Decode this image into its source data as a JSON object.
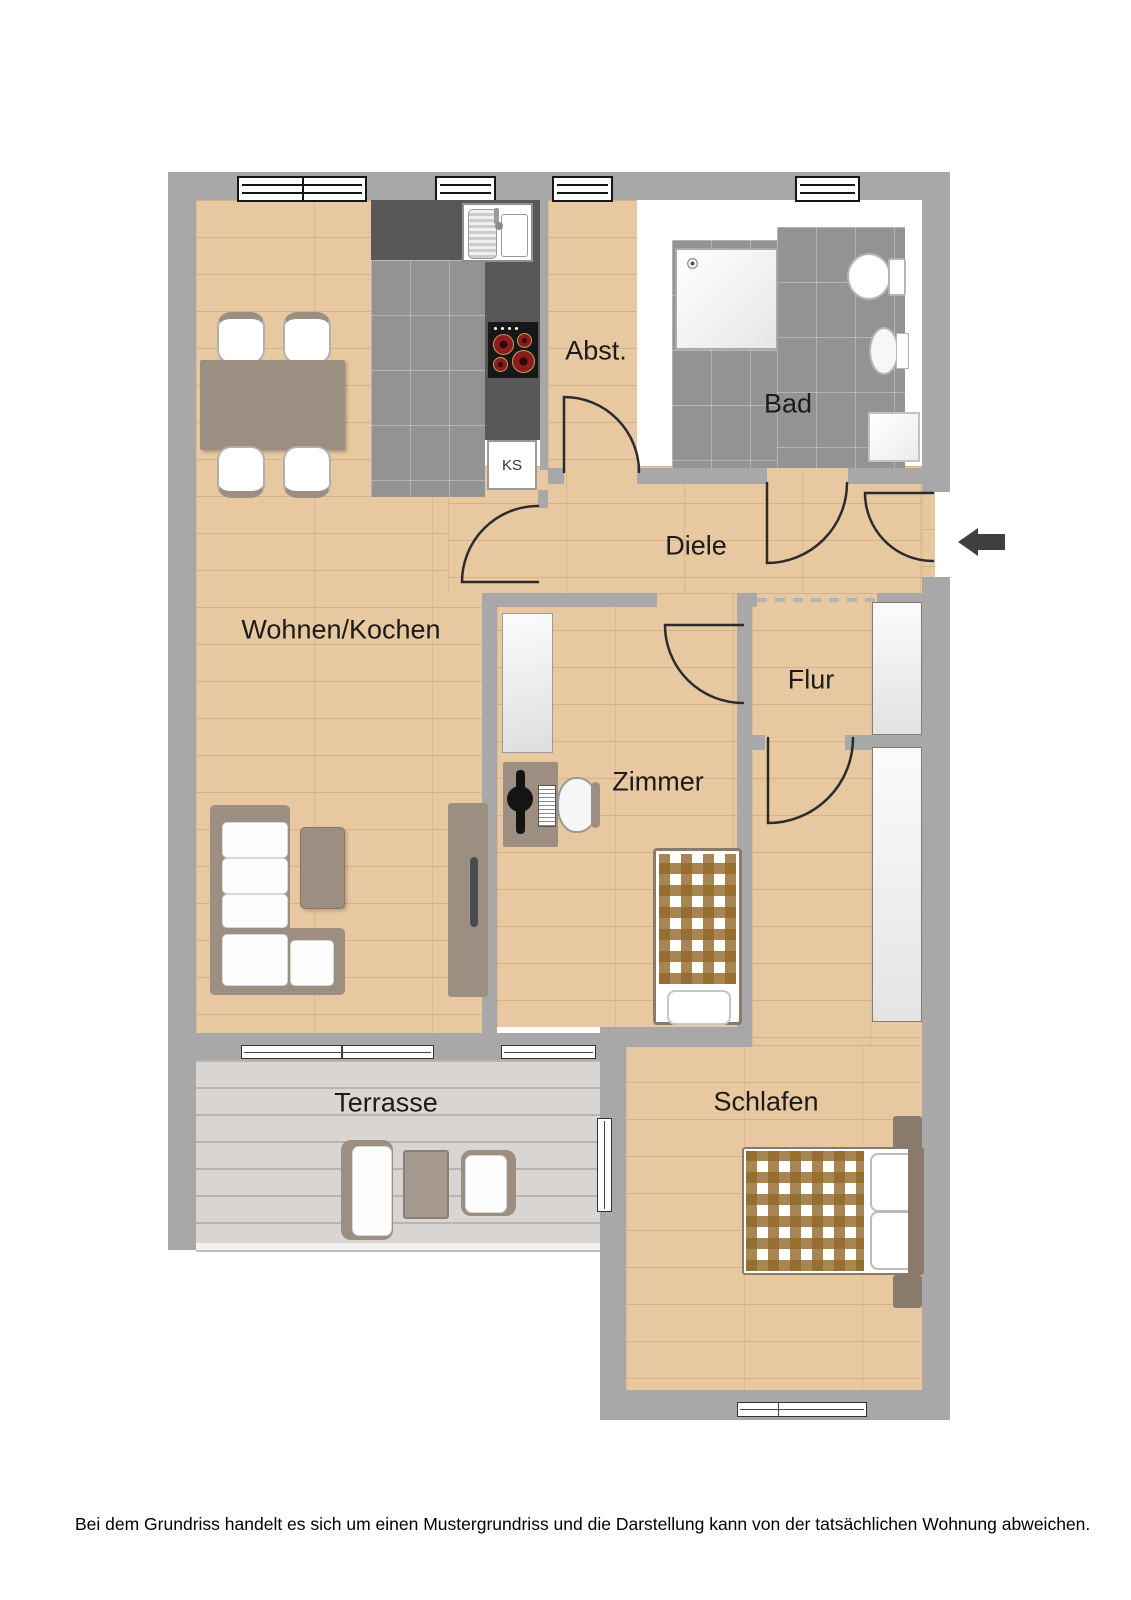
{
  "rooms": [
    {
      "label": "Abst."
    },
    {
      "label": "Bad"
    },
    {
      "label": "Diele"
    },
    {
      "label": "Wohnen/Kochen"
    },
    {
      "label": "Flur"
    },
    {
      "label": "Zimmer"
    },
    {
      "label": "Terrasse"
    },
    {
      "label": "Schlafen"
    }
  ],
  "kitchen": {
    "fridge_label": "KS"
  },
  "entrance": {
    "arrow_direction": "left"
  },
  "disclaimer": "Bei dem Grundriss handelt es sich um einen Mustergrundriss und die Darstellung kann von der tatsächlichen Wohnung abweichen.",
  "colors": {
    "wall": "#a8a8a8",
    "wood_floor": "#e8c8a0",
    "tile_floor": "#939393",
    "deck_floor": "#d9d5d2",
    "kitchen_counter": "#585858",
    "furniture_brown": "#9c8e80",
    "bed_frame_brown": "#8a7a6c",
    "burner_red": "#8c1d1d",
    "entrance_arrow": "#3f3f3f"
  }
}
